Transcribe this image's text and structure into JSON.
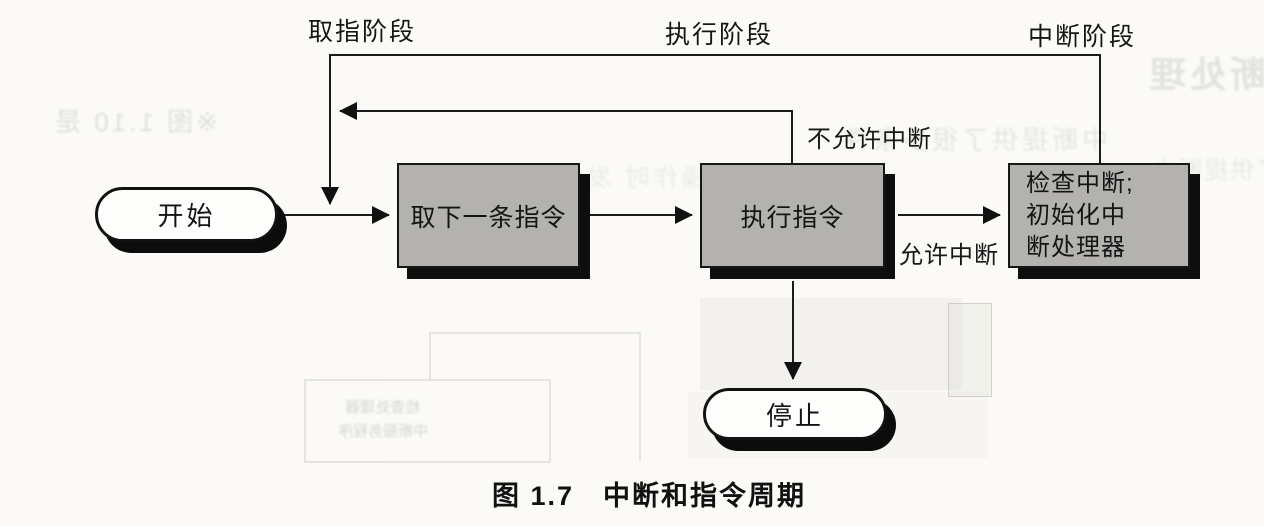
{
  "figure": {
    "caption": "图 1.7　中断和指令周期",
    "phase_labels": {
      "fetch": "取指阶段",
      "execute": "执行阶段",
      "interrupt": "中断阶段"
    },
    "edge_labels": {
      "interrupts_disabled": "不允许中断",
      "interrupts_enabled": "允许中断"
    },
    "nodes": {
      "start": "开始",
      "fetch": "取下一条指令",
      "execute": "执行指令",
      "interrupt_check": "检查中断;\n初始化中\n断处理器",
      "halt": "停止"
    },
    "colors": {
      "paper": "#fbfaf7",
      "box_fill": "#b3b2af",
      "box_border": "#171717",
      "shadow": "#0e0e0e",
      "line": "#1c1c1c"
    }
  },
  "bleedthrough": {
    "heading": "中断处理",
    "line_left": "※图 1.10 是",
    "line_right": "中断提供了很多条件",
    "line_mid": "完成一次I/O操作时 发生",
    "fragment_far_right": "了供提断中",
    "ghost_box_line1": "检查处理器",
    "ghost_box_line2": "中断服务程序"
  }
}
